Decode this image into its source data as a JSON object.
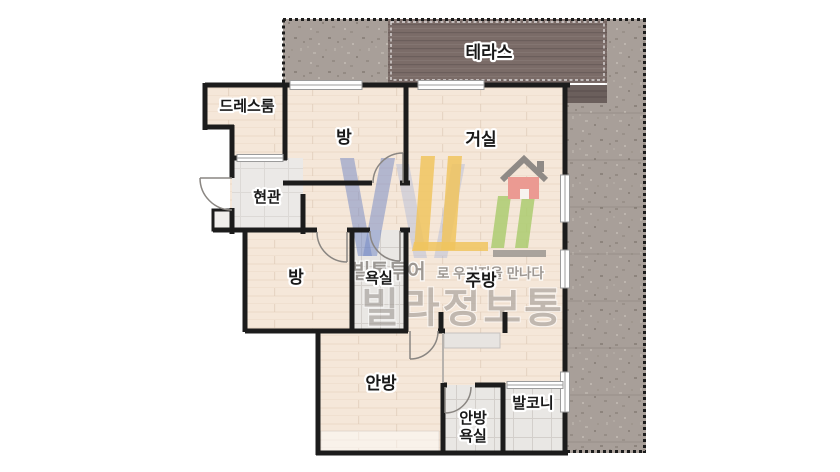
{
  "plan": {
    "labels": {
      "terrace": "테라스",
      "dressroom": "드레스룸",
      "bedroom_top": "방",
      "living_room": "거실",
      "entrance": "현관",
      "bedroom_left": "방",
      "bathroom": "욕실",
      "kitchen": "주방",
      "master_bedroom": "안방",
      "master_bathroom_line1": "안방",
      "master_bathroom_line2": "욕실",
      "balcony": "발코니"
    },
    "colors": {
      "wall": "#1c1c1c",
      "wood_floor": "#f5e7d9",
      "tile_floor": "#e9e7e4",
      "stone_yard": "#a89f99",
      "terrace_deck": "#7b6c68",
      "logo_blue": "#7085c4",
      "logo_blue_light": "#93a4d6",
      "logo_yellow": "#f0c45e",
      "logo_green": "#abcb70",
      "logo_pink": "#eb9a92",
      "logo_roof_gray": "#8f8a86"
    }
  },
  "watermark": {
    "tagline_emphasis": "빌통투어",
    "tagline_rest": "로 우리집을 만나다",
    "brand": "빌라정보통"
  }
}
